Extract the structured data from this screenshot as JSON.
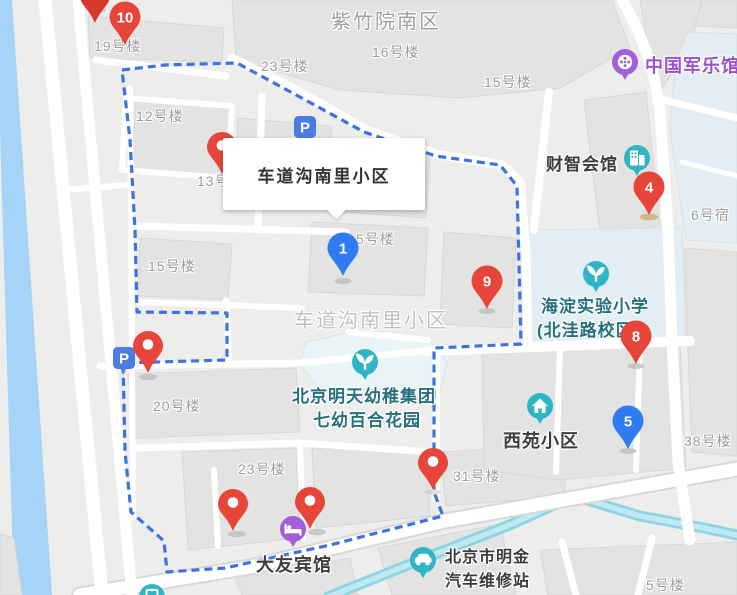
{
  "info_window": {
    "title": "车道沟南里小区"
  },
  "parking": {
    "label": "P"
  },
  "area_labels": [
    {
      "text": "紫竹院南区"
    },
    {
      "text": "车道沟南里小区"
    }
  ],
  "building_labels": [
    "19号楼",
    "12号楼",
    "13号楼",
    "23号楼",
    "16号楼",
    "15号楼",
    "15号楼",
    "5号楼",
    "20号楼",
    "23号楼",
    "31号楼",
    "38号楼",
    "6号宿",
    "5号楼"
  ],
  "pois": [
    {
      "name": "中国军乐馆",
      "lines": [
        "中国军乐馆"
      ],
      "icon": "music-reel-icon",
      "icon_color": "#a35fd9",
      "text_color": "#9b51cf"
    },
    {
      "name": "财智会馆",
      "lines": [
        "财智会馆"
      ],
      "icon": "office-building-icon",
      "icon_color": "#2fb5c5",
      "text_color": "#3d3d3d"
    },
    {
      "name": "海淀实验小学(北洼路校区)",
      "lines": [
        "海淀实验小学",
        "(北洼路校区)"
      ],
      "icon": "sprout-icon",
      "icon_color": "#2fb5c5",
      "text_color": "#25707d"
    },
    {
      "name": "北京明天幼稚集团七幼百合花园",
      "lines": [
        "北京明天幼稚集团",
        "七幼百合花园"
      ],
      "icon": "sprout-icon",
      "icon_color": "#2fb5c5",
      "text_color": "#25707d"
    },
    {
      "name": "西苑小区",
      "lines": [
        "西苑小区"
      ],
      "icon": "house-icon",
      "icon_color": "#2fb5c5",
      "text_color": "#3d3d3d"
    },
    {
      "name": "大友宾馆",
      "lines": [
        "大友宾馆"
      ],
      "icon": "bed-icon",
      "icon_color": "#a35fd9",
      "text_color": "#3d3d3d"
    },
    {
      "name": "北京市明金汽车维修站",
      "lines": [
        "北京市明金",
        "汽车维修站"
      ],
      "icon": "car-icon",
      "icon_color": "#2fb5c5",
      "text_color": "#3d3d3d"
    },
    {
      "name": "公交站",
      "lines": [],
      "icon": "bus-icon",
      "icon_color": "#2fb5c5",
      "text_color": ""
    }
  ],
  "markers": [
    {
      "label": "10",
      "color": "#e8453a"
    },
    {
      "label": "1",
      "color": "#2e7cf0"
    },
    {
      "label": "4",
      "color": "#e8453a"
    },
    {
      "label": "9",
      "color": "#e8453a"
    },
    {
      "label": "8",
      "color": "#e8453a"
    },
    {
      "label": "5",
      "color": "#2e7cf0"
    }
  ],
  "colors": {
    "boundary_dashed": "#3d72e0",
    "water": "#a6d4f8",
    "river": "#8ed4e4",
    "marker_red": "#e8453a",
    "marker_blue": "#2e7cf0",
    "poi_teal": "#2fb5c5",
    "poi_purple": "#a35fd9",
    "parking_blue": "#4b7ce2",
    "building_fill": "#e3e3e2",
    "school_ground_fill": "#e2eef3"
  }
}
